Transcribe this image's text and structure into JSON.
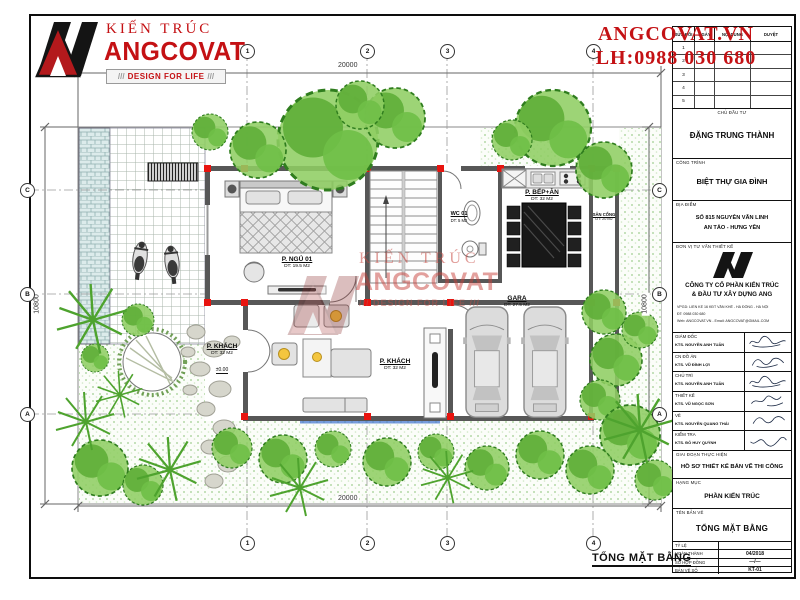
{
  "logo": {
    "brand_top": "KIẾN TRÚC",
    "brand_name": "ANGCOVAT",
    "tagline": "DESIGN FOR LIFE",
    "hatch": "///"
  },
  "contact": {
    "website": "ANGCOVAT.VN",
    "phone": "LH:0988 030 680"
  },
  "watermark": {
    "line1": "KIẾN TRÚC",
    "line2": "ANGCOVAT",
    "line3": "/// DESIGN FOR LIFE ///"
  },
  "colors": {
    "accent_red": "#c41114",
    "marker_red": "#e8140f",
    "wall_gray": "#575757",
    "tree_green": "#57a836"
  },
  "plan": {
    "sheet_title": "TỔNG MẶT BẰNG",
    "dim_top": "20000",
    "dim_bottom": "20000",
    "dim_left": "10800",
    "dim_right": "10800",
    "grid_cols": [
      "1",
      "2",
      "3",
      "4"
    ],
    "grid_rows": [
      "C",
      "B",
      "A"
    ],
    "rooms": {
      "bedroom": {
        "name": "P. NGỦ 01",
        "area": "DT: 19.5 M2"
      },
      "wc": {
        "name": "WC 01",
        "area": "DT: 5 M2"
      },
      "kitchen": {
        "name": "P. BẾP+ĂN",
        "area": "DT: 32 M2"
      },
      "living_entry": {
        "name": "P. KHÁCH",
        "area": "DT: 32 M2",
        "level": "±0.00"
      },
      "living": {
        "name": "P. KHÁCH",
        "area": "DT: 32 M2"
      },
      "garage": {
        "name": "GARA",
        "area": "DT: 27.5 M2"
      },
      "gate_yard": {
        "name": "SÂN CỔNG",
        "area": "DT: 20 M2"
      }
    }
  },
  "titleblock": {
    "revision": {
      "headers": [
        "SỬA ĐỔI",
        "NGÀY",
        "NỘI DUNG",
        "DUYỆT"
      ],
      "rows": [
        "1",
        "2",
        "3",
        "4",
        "5"
      ]
    },
    "investor": {
      "label": "CHỦ ĐẦU TƯ",
      "value": "ĐẶNG TRUNG THÀNH"
    },
    "project": {
      "label": "CÔNG TRÌNH",
      "value": "BIỆT THỰ GIA ĐÌNH"
    },
    "location": {
      "label": "ĐỊA ĐIỂM",
      "value1": "SỐ 815 NGUYỄN VĂN LINH",
      "value2": "AN TẢO - HƯNG YÊN"
    },
    "consultant": {
      "label": "ĐƠN VỊ TƯ VẤN THIẾT KẾ",
      "company1": "CÔNG TY CỔ PHẦN KIẾN TRÚC",
      "company2": "& ĐẦU TƯ XÂY DỰNG ANG",
      "contact1": "VPGD: LIỀN KỀ 16 KĐT VĂN KHÊ - HÀ ĐÔNG - HÀ NỘI",
      "contact2": "ĐT: 0988 030 680",
      "contact3": "Web: ANGCOVAT.VN - Email: ANGCOVAT@GMAIL.COM"
    },
    "signatures": [
      {
        "role": "GIÁM ĐỐC",
        "name": "KTS. NGUYỄN ANH TUẤN"
      },
      {
        "role": "CN ĐỒ ÁN",
        "name": "KTS. VŨ ĐÌNH LỢI"
      },
      {
        "role": "CHỦ TRÌ",
        "name": "KTS. NGUYỄN ANH TUẤN"
      },
      {
        "role": "THIẾT KẾ",
        "name": "KTS. VŨ NGỌC SƠN"
      },
      {
        "role": "VẼ",
        "name": "KTS. NGUYỄN QUANG THÁI"
      },
      {
        "role": "KIỂM TRA",
        "name": "KTS. ĐỖ HUY QUỲNH"
      }
    ],
    "phase": {
      "label": "GIAI ĐOẠN THỰC HIỆN",
      "value": "HỒ SƠ THIẾT KẾ BẢN VẼ THI CÔNG"
    },
    "category": {
      "label": "HẠNG MỤC",
      "value": "PHẦN KIẾN TRÚC"
    },
    "drawing_name": {
      "label": "TÊN BẢN VẼ",
      "value": "TỔNG MẶT BẰNG"
    },
    "footer": [
      {
        "label": "TỶ LỆ",
        "value": ""
      },
      {
        "label": "HOÀN THÀNH",
        "value": "04/2018"
      },
      {
        "label": "SỐ HỢP ĐỒNG",
        "value": "—/—"
      },
      {
        "label": "BẢN VẼ SỐ",
        "value": "KT-01"
      }
    ]
  }
}
